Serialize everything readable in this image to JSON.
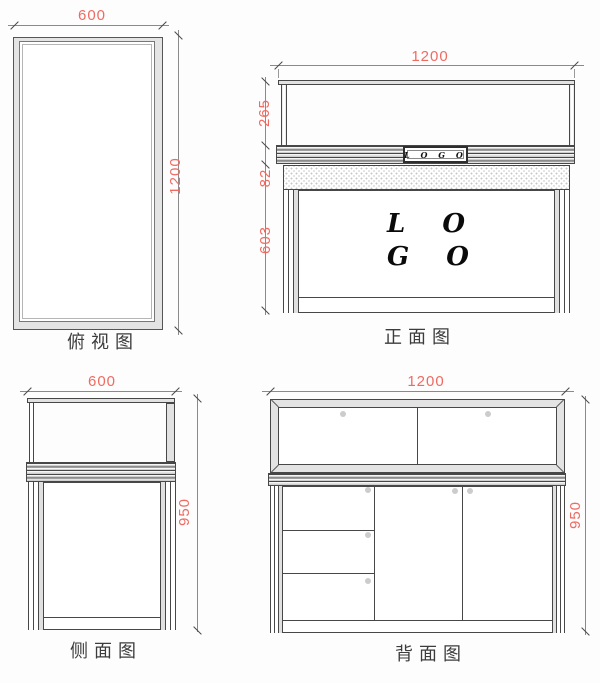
{
  "colors": {
    "dimension_red": "#ef6b62",
    "line": "#474747"
  },
  "views": {
    "top": {
      "label": "俯视图",
      "width_dim": "600",
      "height_dim": "1200"
    },
    "front": {
      "label": "正面图",
      "width_dim": "1200",
      "upper_dim": "265",
      "band_dim": "82",
      "lower_dim": "603",
      "logo_plate_text": "L O G O",
      "logo_big_line1": "L O",
      "logo_big_line2": "G O"
    },
    "side": {
      "label": "侧面图",
      "width_dim": "600",
      "height_dim": "950"
    },
    "back": {
      "label": "背面图",
      "width_dim": "1200",
      "height_dim": "950"
    }
  }
}
